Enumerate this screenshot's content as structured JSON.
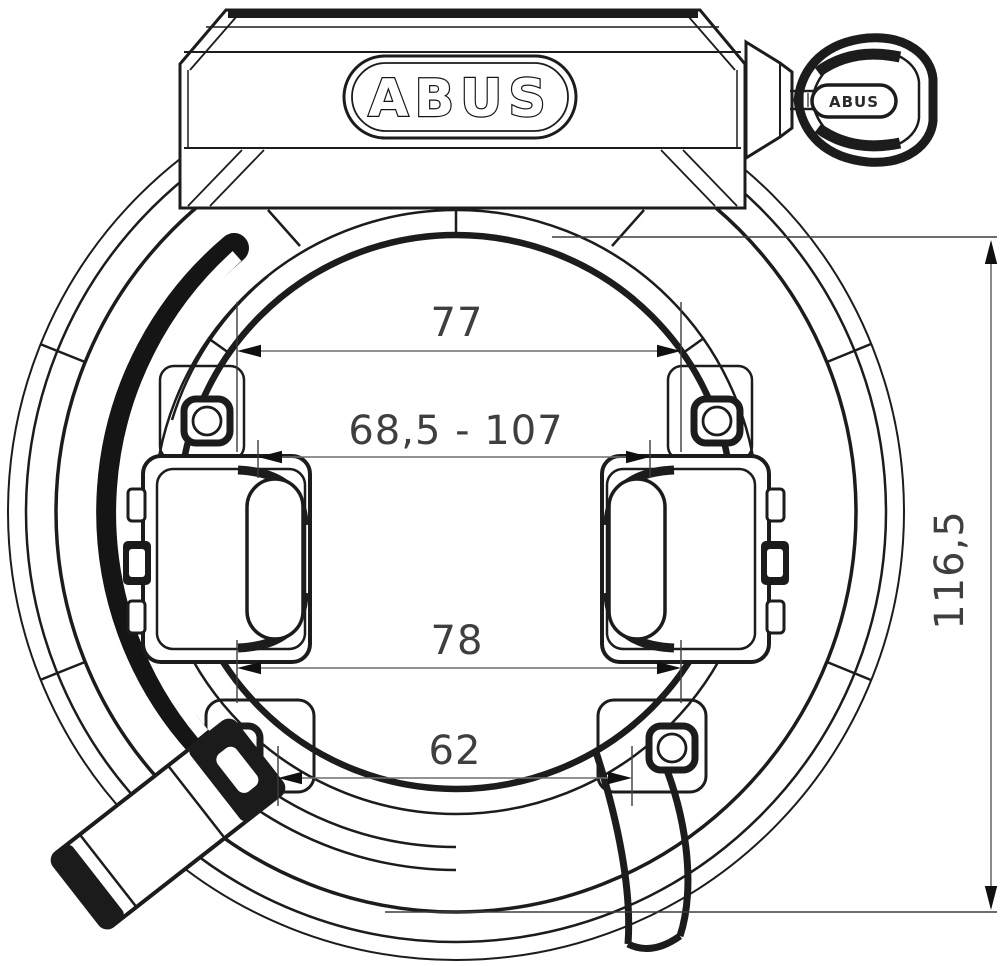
{
  "drawing": {
    "kind": "technical-line-drawing",
    "brand_plate_text": "ABUS",
    "key_head_text": "ABUS",
    "dimensions": {
      "upper_inner_width": "77",
      "mounting_range": "68,5 - 107",
      "lower_inner_width": "78",
      "bottom_opening_width": "62",
      "overall_height": "116,5"
    }
  },
  "colors": {
    "ink": "#1c1c1c",
    "background": "#ffffff",
    "dimension_line": "#6e6e6e",
    "dimension_text": "#3f3f3f",
    "arrowhead": "#101010"
  }
}
